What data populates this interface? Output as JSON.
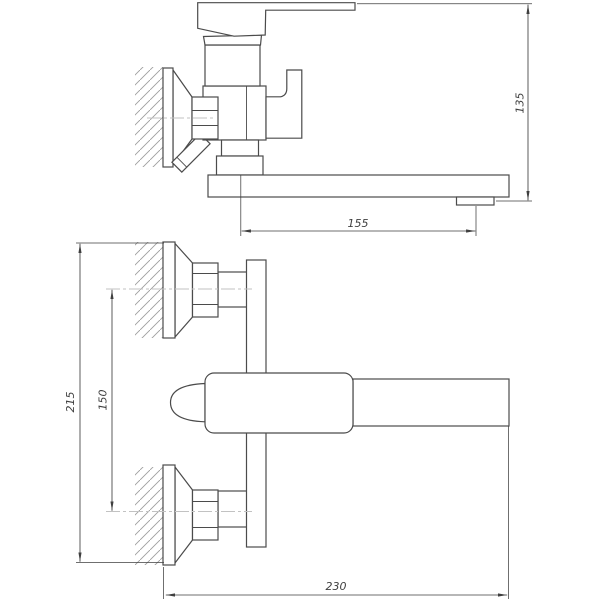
{
  "colors": {
    "background": "#ffffff",
    "outline": "#4b4b4b",
    "dimension": "#3f3f3f",
    "hatch": "#9e9e9e",
    "centerline": "#c2c2c2"
  },
  "views": {
    "side": {
      "dimensions": {
        "height": "135",
        "spout_reach": "155"
      }
    },
    "front": {
      "dimensions": {
        "overall_height": "215",
        "mounting_centers": "150",
        "overall_width": "230"
      }
    }
  }
}
